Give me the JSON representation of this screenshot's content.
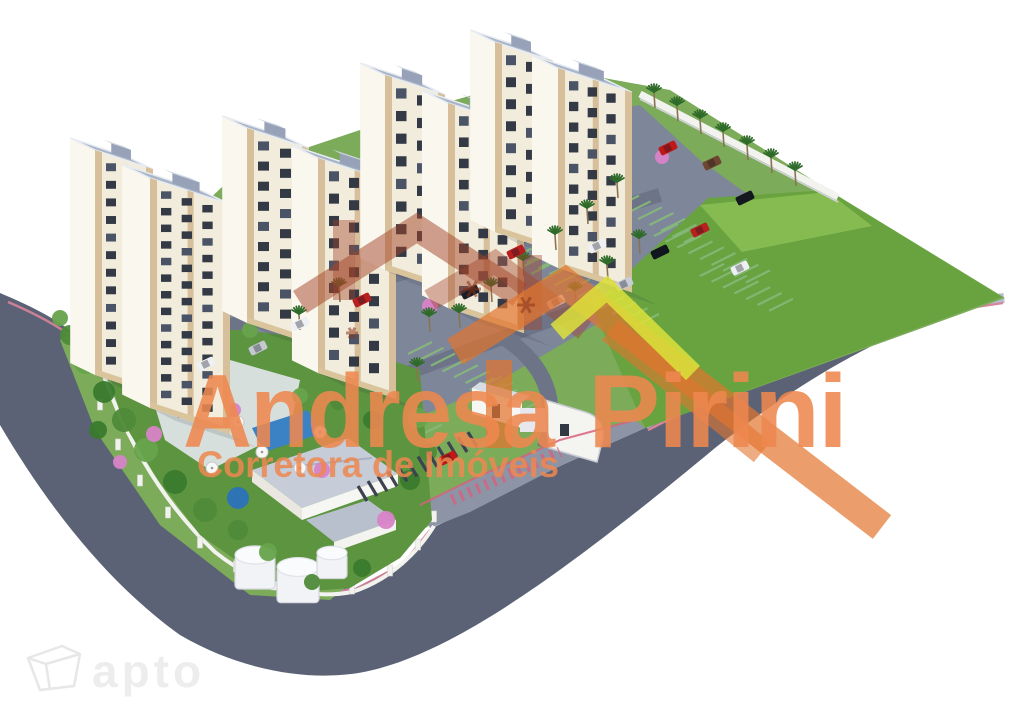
{
  "image": {
    "kind": "3D aerial rendering",
    "subject": "Residential condominium complex: apartment towers, parking lots, leisure area, lawn and curved access road"
  },
  "watermark": {
    "brand": "Andresa Pirini",
    "brand_word1": "Andresa",
    "brand_word2": "Pirini",
    "tagline": "Corretora de Imóveis",
    "brand_color": "#ee8850",
    "logo": {
      "roof_red": "#a34328",
      "roof_orange": "#e2752e",
      "roof_yellow": "#dde23b"
    }
  },
  "corner_logo": {
    "text": "apto",
    "color": "#ededed"
  },
  "palette": {
    "background": "#ffffff",
    "road": "#5b6275",
    "sidewalk": "#b6bed2",
    "road_marking_pink": "#d8849a",
    "lawn": "#68a33f",
    "ground_green": "#7cab5a",
    "parking_asphalt": "#7e8699",
    "parking_stripe_green": "#86b97a",
    "building_wall": "#f1ecdb",
    "building_wall_light": "#faf7ee",
    "building_roof": "#a9b6c9",
    "building_accent": "#d3ba92",
    "window_dark": "#333a46",
    "pool_blue": "#2a6db0",
    "flower_tree_pink": "#d883c8",
    "palm_green": "#2f6b2a",
    "wall_white": "#f2f2ee"
  }
}
